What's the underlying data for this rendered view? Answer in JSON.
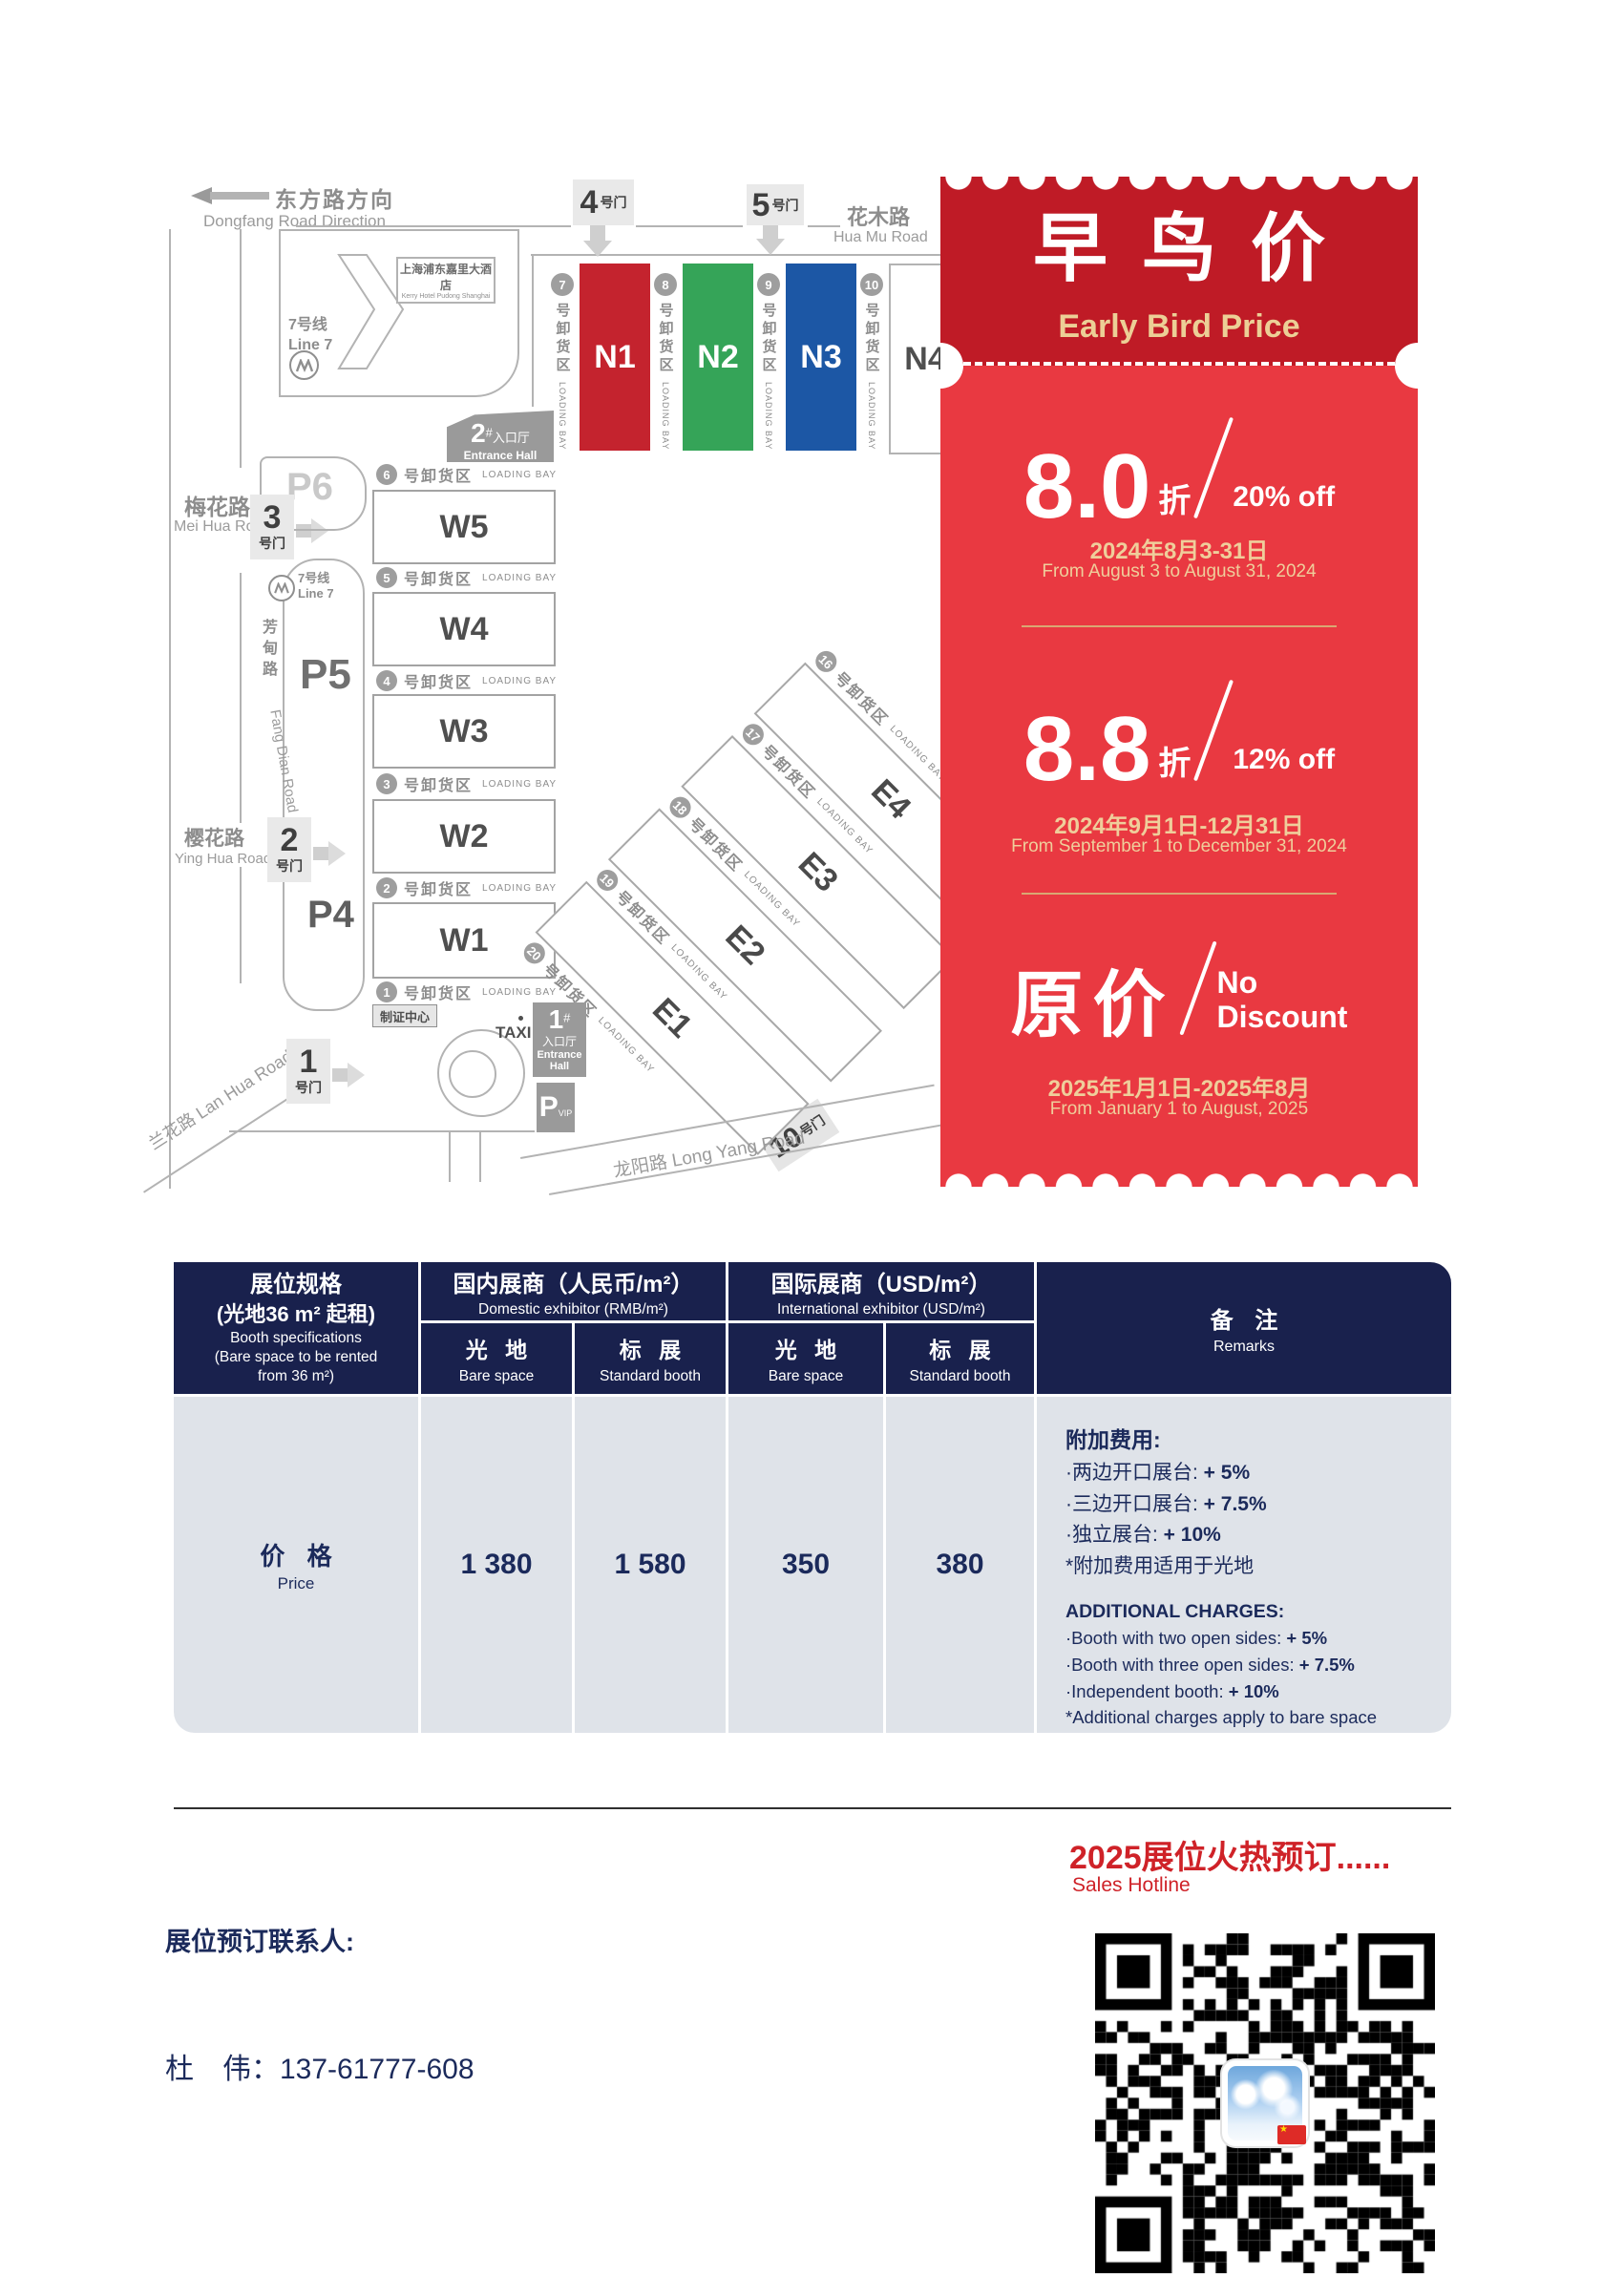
{
  "colors": {
    "hall_n1": "#c4232e",
    "hall_n2": "#35a458",
    "hall_n3": "#1c57a5",
    "ticket_header": "#bf1b26",
    "ticket_body": "#e93941",
    "gold": "#e8c793",
    "table_navy": "#19214d",
    "table_gray": "#dfe3e9",
    "accent_red": "#cf2228"
  },
  "map": {
    "direction": {
      "zh": "东方路方向",
      "en": "Dongfang Road Direction"
    },
    "hotel": {
      "zh": "上海浦东嘉里大酒店",
      "en": "Kerry Hotel Pudong Shanghai"
    },
    "metro": {
      "zh": "7号线",
      "en": "Line 7"
    },
    "roads": {
      "meihua": {
        "zh": "梅花路",
        "en": "Mei Hua Road"
      },
      "fangdian": {
        "zh": "芳甸路",
        "en": "Fang Dian Road"
      },
      "yinghua": {
        "zh": "樱花路",
        "en": "Ying Hua Road"
      },
      "lanhua": {
        "zh": "兰花路 Lan Hua Road"
      },
      "huamu": {
        "zh": "花木路",
        "en": "Hua Mu Road"
      },
      "longyang": {
        "zh": "龙阳路  Long Yang Road"
      }
    },
    "gate_suffix": "号门",
    "gates": {
      "g1": "1",
      "g2": "2",
      "g3": "3",
      "g4": "4",
      "g5": "5",
      "g10": "10"
    },
    "parking": {
      "p4": "P4",
      "p5": "P5",
      "p6": "P6",
      "vip_p": "P",
      "vip": "VIP"
    },
    "entrance1": {
      "num": "1",
      "hash": "#",
      "zh": "入口厅",
      "en1": "Entrance",
      "en2": "Hall"
    },
    "entrance2": {
      "num": "2",
      "hash": "#",
      "zh": "入口厅",
      "en": "Entrance Hall"
    },
    "badge_center": "制证中心",
    "taxi": "TAXI",
    "bay_zh": "号卸货区",
    "bay_en": "LOADING BAY",
    "bay1": "1",
    "bay20": "20",
    "halls_w": [
      {
        "id": "W5",
        "bay": "6"
      },
      {
        "id": "W4",
        "bay": "5"
      },
      {
        "id": "W3",
        "bay": "4"
      },
      {
        "id": "W2",
        "bay": "3"
      },
      {
        "id": "W1",
        "bay": "2"
      }
    ],
    "halls_n": [
      {
        "id": "N1",
        "bay": "7"
      },
      {
        "id": "N2",
        "bay": "8"
      },
      {
        "id": "N3",
        "bay": "9"
      },
      {
        "id": "N4",
        "bay": "10"
      }
    ],
    "halls_e": [
      {
        "id": "E4",
        "bay": "16"
      },
      {
        "id": "E3",
        "bay": "17"
      },
      {
        "id": "E2",
        "bay": "18"
      },
      {
        "id": "E1",
        "bay": "19"
      }
    ]
  },
  "ticket": {
    "title_zh": "早鸟价",
    "title_en": "Early Bird Price",
    "tier1": {
      "big": "8.0",
      "unit": "折",
      "off": "20% off",
      "date_zh": "2024年8月3-31日",
      "date_en": "From August 3 to August 31, 2024"
    },
    "tier2": {
      "big": "8.8",
      "unit": "折",
      "off": "12% off",
      "date_zh": "2024年9月1日-12月31日",
      "date_en": "From September 1 to December 31, 2024"
    },
    "tier3": {
      "big": "原价",
      "off_line1": "No",
      "off_line2": "Discount",
      "date_zh": "2025年1月1日-2025年8月",
      "date_en": "From January 1 to August, 2025"
    }
  },
  "table": {
    "spec": {
      "zh1": "展位规格",
      "zh2": "(光地36 m² 起租)",
      "en1": "Booth specifications",
      "en2": "(Bare space to be rented",
      "en3": "from 36 m²)"
    },
    "domestic": {
      "zh": "国内展商（人民币/m²）",
      "en": "Domestic exhibitor (RMB/m²)"
    },
    "international": {
      "zh": "国际展商（USD/m²）",
      "en": "International exhibitor (USD/m²)"
    },
    "bare": {
      "zh": "光 地",
      "en": "Bare space"
    },
    "standard": {
      "zh": "标 展",
      "en": "Standard booth"
    },
    "remarks_header": {
      "zh": "备 注",
      "en": "Remarks"
    },
    "price_row": {
      "zh": "价 格",
      "en": "Price",
      "values": [
        "1 380",
        "1 580",
        "350",
        "380"
      ]
    },
    "remarks": {
      "zh": {
        "title": "附加费用:",
        "items": [
          {
            "t": "·两边开口展台: ",
            "b": "+ 5%"
          },
          {
            "t": "·三边开口展台: ",
            "b": "+ 7.5%"
          },
          {
            "t": "·独立展台: ",
            "b": "+ 10%"
          }
        ],
        "note": "*附加费用适用于光地"
      },
      "en": {
        "title": "ADDITIONAL CHARGES:",
        "items": [
          {
            "t": "·Booth with two open sides: ",
            "b": "+ 5%"
          },
          {
            "t": "·Booth with three open sides: ",
            "b": "+ 7.5%"
          },
          {
            "t": "·Independent booth: ",
            "b": "+ 10%"
          }
        ],
        "note": "*Additional charges apply to bare space"
      }
    }
  },
  "footer": {
    "hotline_zh": "2025展位火热预订......",
    "hotline_en": "Sales Hotline",
    "contact_title": "展位预订联系人:",
    "contact_name": "杜　伟：",
    "contact_phone": "137-61777-608"
  }
}
